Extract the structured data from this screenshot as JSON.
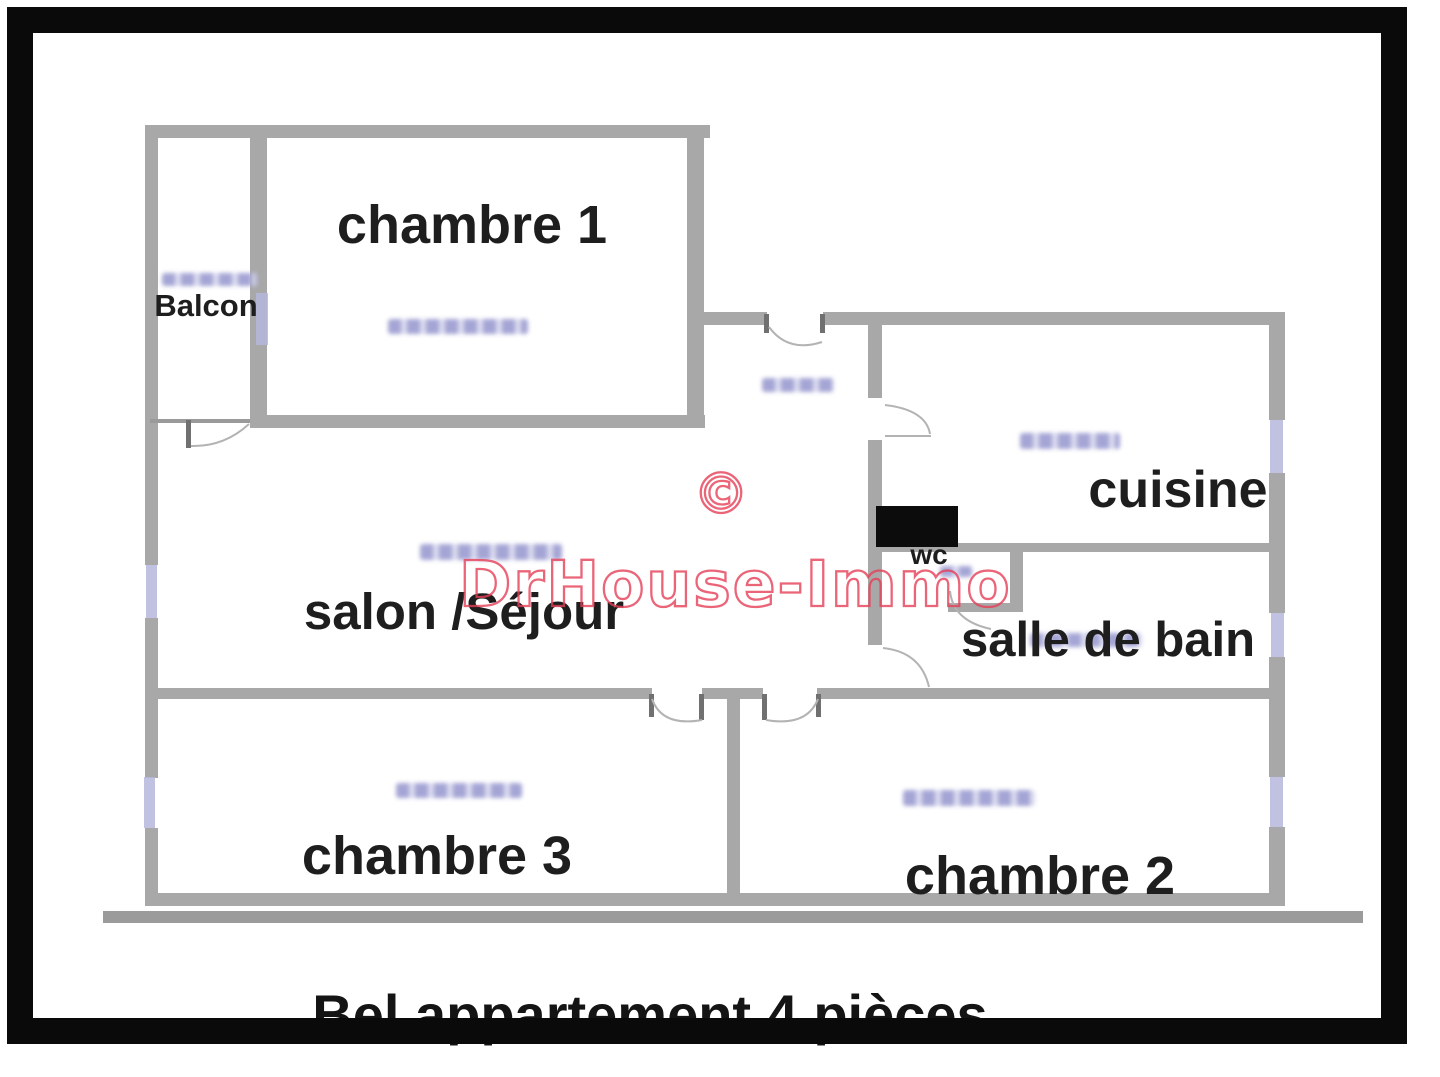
{
  "caption": {
    "text": "Bel appartement 4 pièces"
  },
  "watermark": {
    "copyright_symbol": "©",
    "brand": "DrHouse-Immo",
    "color": "#e63e58"
  },
  "rooms": [
    {
      "id": "balcon",
      "label": "Balcon"
    },
    {
      "id": "chambre-1",
      "label": "chambre 1"
    },
    {
      "id": "cuisine",
      "label": "cuisine"
    },
    {
      "id": "wc",
      "label": "wc"
    },
    {
      "id": "salle-de-bain",
      "label": "salle de bain"
    },
    {
      "id": "salon-sejour",
      "label": "salon /Séjour"
    },
    {
      "id": "chambre-3",
      "label": "chambre 3"
    },
    {
      "id": "chambre-2",
      "label": "chambre 2"
    }
  ],
  "colors": {
    "wall": "#a8a8a8",
    "window_marker": "#b6b6dc",
    "frame": "#0a0a0a",
    "label_text": "#1e1e1e",
    "wc_fixture": "#0c0c0c",
    "ground_line": "#9b9b9b"
  }
}
